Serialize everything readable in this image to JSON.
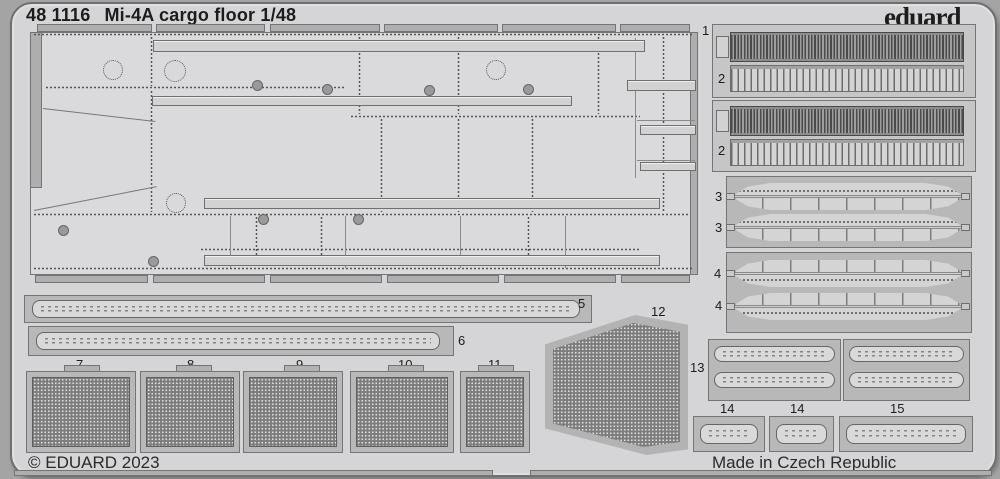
{
  "header": {
    "code": "48 1116",
    "title": "Mi-4A cargo floor 1/48",
    "brand": "eduard"
  },
  "footer": {
    "copyright": "© EDUARD 2023",
    "origin": "Made in Czech Republic"
  },
  "part_labels": {
    "p1": "1",
    "p2a": "2",
    "p2b": "2",
    "p3a": "3",
    "p3b": "3",
    "p4a": "4",
    "p4b": "4",
    "p5": "5",
    "p6": "6",
    "p7": "7",
    "p8": "8",
    "p9": "9",
    "p10": "10",
    "p11": "11",
    "p12": "12",
    "p13": "13",
    "p14a": "14",
    "p14b": "14",
    "p15": "15"
  },
  "colors": {
    "background": "#a4a4a4",
    "sheet": "#d5d5d7",
    "frame": "#b8b8b8",
    "mesh": "#7d7d7d",
    "rib_dark": "#4a4a4a",
    "text": "#1c1c1c"
  }
}
